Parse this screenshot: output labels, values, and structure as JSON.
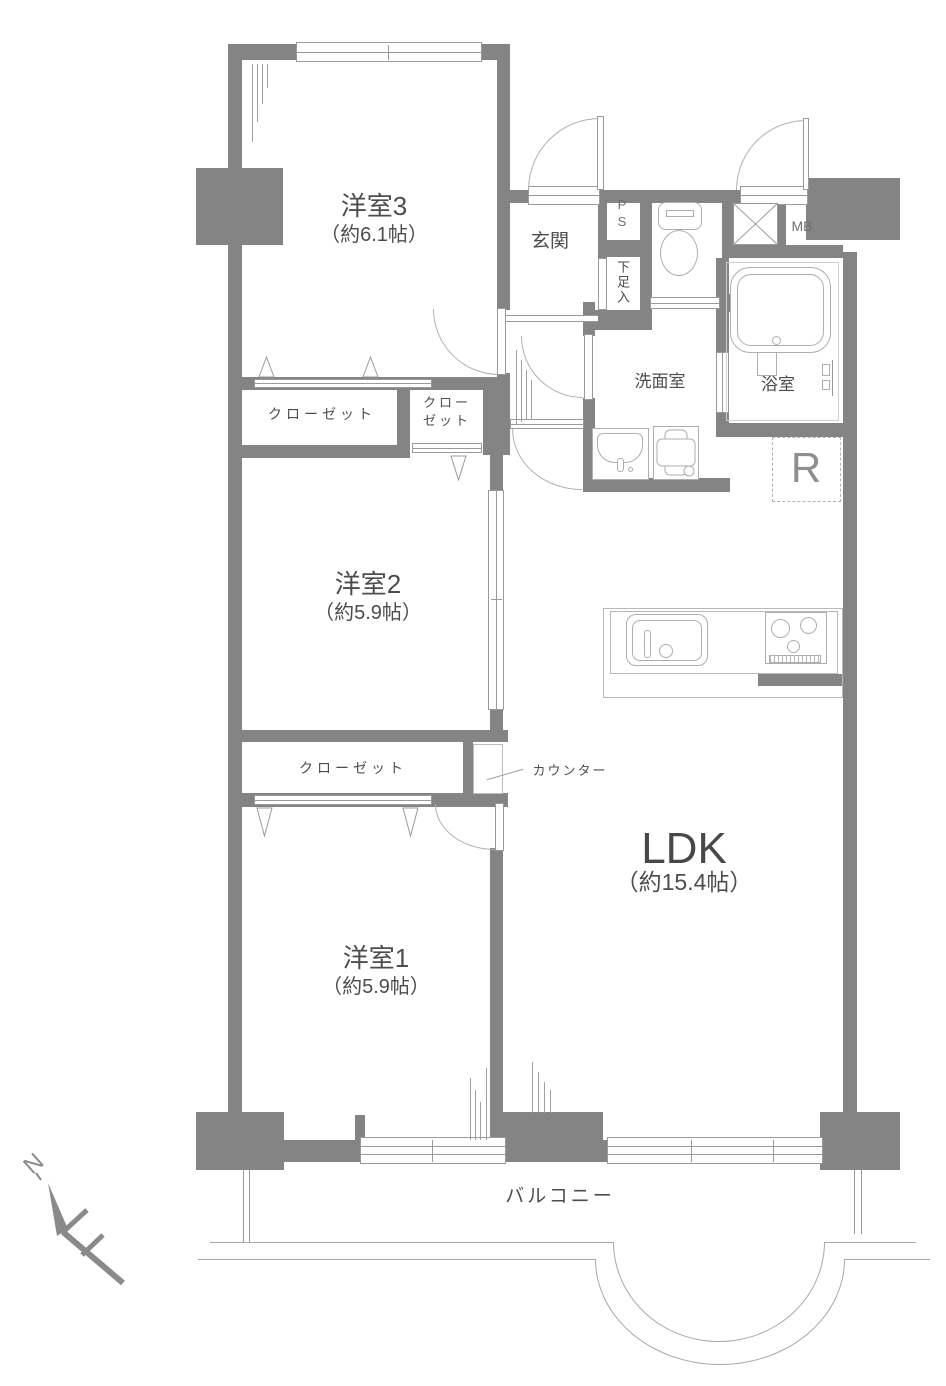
{
  "colors": {
    "wall": "#848484",
    "thin_line": "#9a9a9a",
    "text": "#4d4d4d",
    "text_light": "#8f8f8f"
  },
  "rooms": {
    "room3": {
      "name": "洋室3",
      "size": "（約6.1帖）"
    },
    "room2": {
      "name": "洋室2",
      "size": "（約5.9帖）"
    },
    "room1": {
      "name": "洋室1",
      "size": "（約5.9帖）"
    },
    "ldk": {
      "name": "LDK",
      "size": "（約15.4帖）"
    }
  },
  "labels": {
    "entrance": "玄関",
    "washroom": "洗面室",
    "bathroom": "浴室",
    "closet_room3": "クローゼット",
    "closet_small_line1": "クロー",
    "closet_small_line2": "ゼット",
    "closet_room2": "クローゼット",
    "counter": "カウンター",
    "pipe_space_line1": "P",
    "pipe_space_line2": "S",
    "shoe_cabinet": "下足入",
    "meter_box": "MB",
    "refrigerator_space": "R",
    "balcony": "バルコニー",
    "compass_north": "N"
  }
}
